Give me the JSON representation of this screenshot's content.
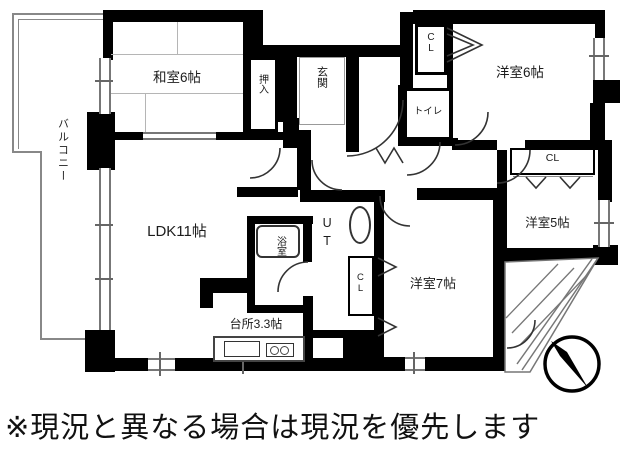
{
  "plan": {
    "labels": {
      "balcony_left": "バルコニー",
      "washitsu": "和室6帖",
      "oshiire": "押入",
      "genkan": "玄関",
      "cl_top": "CL",
      "yoshitsu6": "洋室6帖",
      "toilet": "トイレ",
      "cl_right": "CL",
      "yoshitsu5": "洋室5帖",
      "ldk": "LDK11帖",
      "bath": "浴室",
      "ut": "UT",
      "cl_center": "CL",
      "yoshitsu7": "洋室7帖",
      "kitchen": "台所3.3帖",
      "balcony_right": "バルコニー"
    },
    "icons": {
      "compass": "north-arrow-compass"
    }
  },
  "footer": {
    "disclaimer": "※現況と異なる場合は現況を優先します"
  },
  "colors": {
    "wall": "#000000",
    "thin_line": "#777777",
    "background": "#ffffff"
  }
}
